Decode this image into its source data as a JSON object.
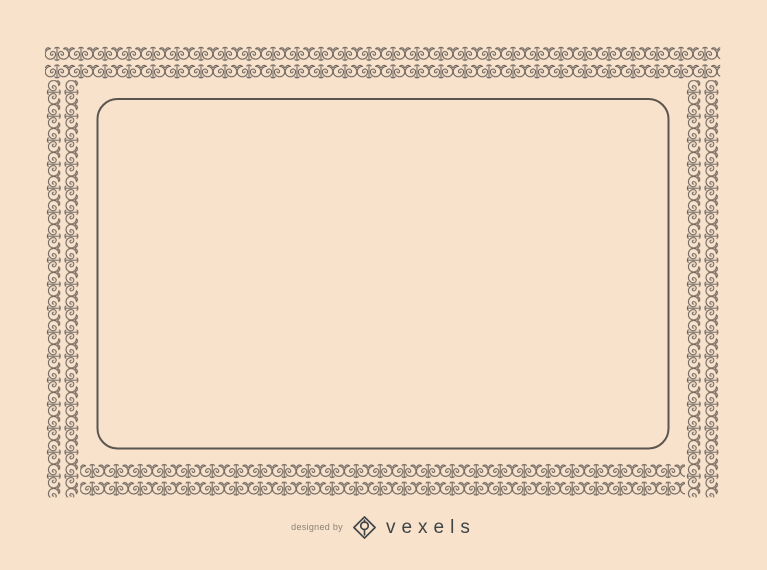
{
  "canvas": {
    "width": 767,
    "height": 570,
    "background": "#f8e2cb"
  },
  "frame": {
    "description": "ornate repeating scroll/spiral border, two rows thick, with empty rounded-rectangle inner frame",
    "ornament_color": "#6b635d",
    "inner_border_color": "#5a5550"
  },
  "credit": {
    "prefix": "designed by",
    "brand": "vexels",
    "icon": "diamond-pen-logo",
    "brand_color": "#3f4446",
    "prefix_color": "#8b8177"
  }
}
